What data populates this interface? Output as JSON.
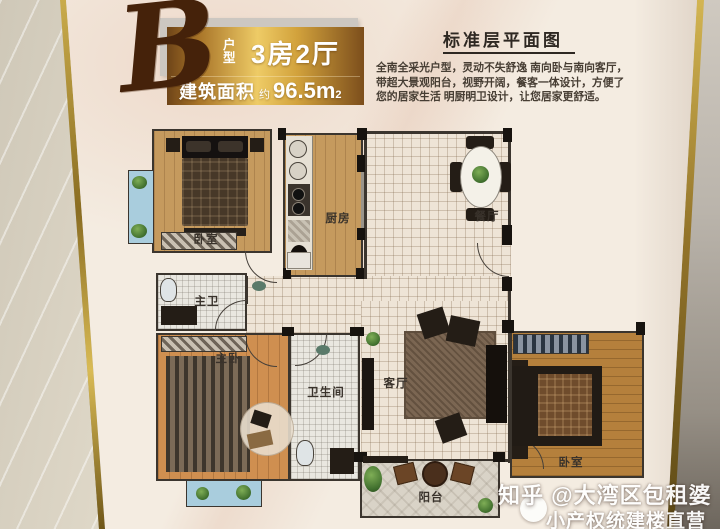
{
  "poster": {
    "unit_letter": "B",
    "unit_label": "户型",
    "unit_rooms": "3房2厅",
    "area_prefix": "建筑面积",
    "area_approx": "约",
    "area_value": "96.5m",
    "area_sup": "2",
    "plan_title": "标准层平面图",
    "description_lines": [
      "全南全采光户型，灵动不失舒逸 南向卧与南向客厅，",
      "带超大景观阳台，视野开阔，餐客一体设计，方便了",
      "您的居家生活 明厨明卫设计，让您居家更舒适。"
    ]
  },
  "floorplan": {
    "rooms": [
      {
        "id": "bedroom-top",
        "label": "卧室"
      },
      {
        "id": "kitchen",
        "label": "厨房"
      },
      {
        "id": "dining",
        "label": "餐厅"
      },
      {
        "id": "master-bath",
        "label": "主卫"
      },
      {
        "id": "master-bedroom",
        "label": "主卧"
      },
      {
        "id": "bathroom",
        "label": "卫生间"
      },
      {
        "id": "living",
        "label": "客厅"
      },
      {
        "id": "balcony",
        "label": "阳台"
      },
      {
        "id": "bedroom-right",
        "label": "卧室"
      }
    ]
  },
  "watermark": {
    "line1": "知乎 @大湾区包租婆",
    "line2": "小产权统建楼直营"
  },
  "colors": {
    "frame-gold": "#ab8a33",
    "banner-gold-light": "#eecb66",
    "banner-gold-dark": "#6e4418",
    "script-brown": "#45220a",
    "poster-bg": "#f4ece1",
    "marble-wall": "#e3dccc",
    "side-wall": "#a9a29a",
    "wall-line": "#3b352e",
    "wood-light": "#c59a5e",
    "wood-orange": "#cf8f50",
    "wood-dark": "#b5803c",
    "tile-bg": "#eee4d6",
    "bath-tile": "#e9e7e0",
    "bay-blue": "#a9cddd",
    "balcony-stone": "#d9d3c7",
    "label-ink": "#39322b",
    "heading-ink": "#2e2822",
    "watermark-white": "#ffffff"
  }
}
